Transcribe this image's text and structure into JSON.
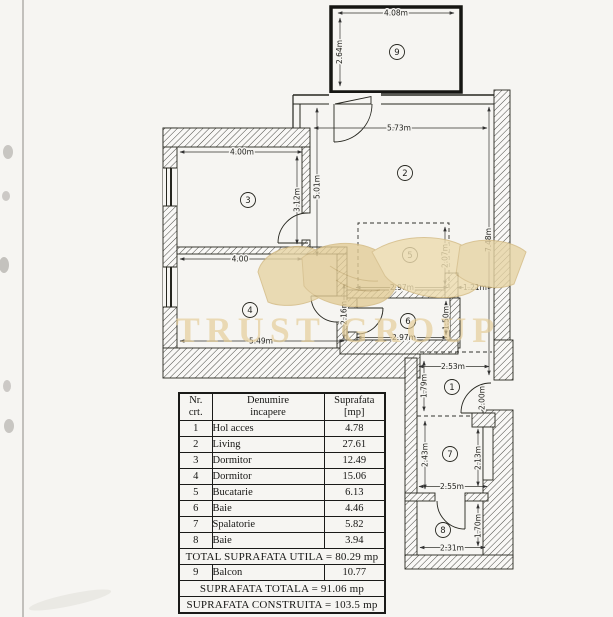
{
  "plan": {
    "watermark": "TRUST GROUP",
    "rooms": {
      "hall": "1",
      "living": "2",
      "bedroom3": "3",
      "bedroom4": "4",
      "kitchen": "5",
      "bath6": "6",
      "laundry": "7",
      "bath8": "8",
      "balcony": "9"
    },
    "dims": {
      "balcony_width": "4.08m",
      "balcony_depth": "2.64m",
      "living_width": "5.73m",
      "right_side_height": "7.48m",
      "bedroom3_width": "4.00m",
      "bedroom3_height": "3.12m",
      "left_inner_height": "5.01m",
      "bedroom4_top_width": "4.00",
      "bedroom4_bottom_width": "5.49m",
      "bedroom4_passage": "2.16m",
      "kitchen_height": "2.07m",
      "kitchen_width": "2.97m",
      "kitchen_gap": "1.21m",
      "bath6_height": "1.50m",
      "bath6_width": "2.97m",
      "hall_width": "2.53m",
      "hall_height": "1.79m",
      "entrance_height": "2.00m",
      "laundry_left_height": "2.43m",
      "laundry_right_height": "2.13m",
      "laundry_width": "2.55m",
      "bath8_height": "1.70m",
      "bath8_width": "2.31m"
    }
  },
  "table": {
    "headers": {
      "nr": "Nr.\ncrt.",
      "name": "Denumire\nincapere",
      "area": "Suprafata\n[mp]"
    },
    "rows": [
      [
        "1",
        "Hol acces",
        "4.78"
      ],
      [
        "2",
        "Living",
        "27.61"
      ],
      [
        "3",
        "Dormitor",
        "12.49"
      ],
      [
        "4",
        "Dormitor",
        "15.06"
      ],
      [
        "5",
        "Bucatarie",
        "6.13"
      ],
      [
        "6",
        "Baie",
        "4.46"
      ],
      [
        "7",
        "Spalatorie",
        "5.82"
      ],
      [
        "8",
        "Baie",
        "3.94"
      ]
    ],
    "total_utila": "TOTAL SUPRAFATA UTILA = 80.29 mp",
    "balcon_row": [
      "9",
      "Balcon",
      "10.77"
    ],
    "total_row": "SUPRAFATA TOTALA = 91.06 mp",
    "construita_row": "SUPRAFATA CONSTRUITA = 103.5 mp"
  }
}
